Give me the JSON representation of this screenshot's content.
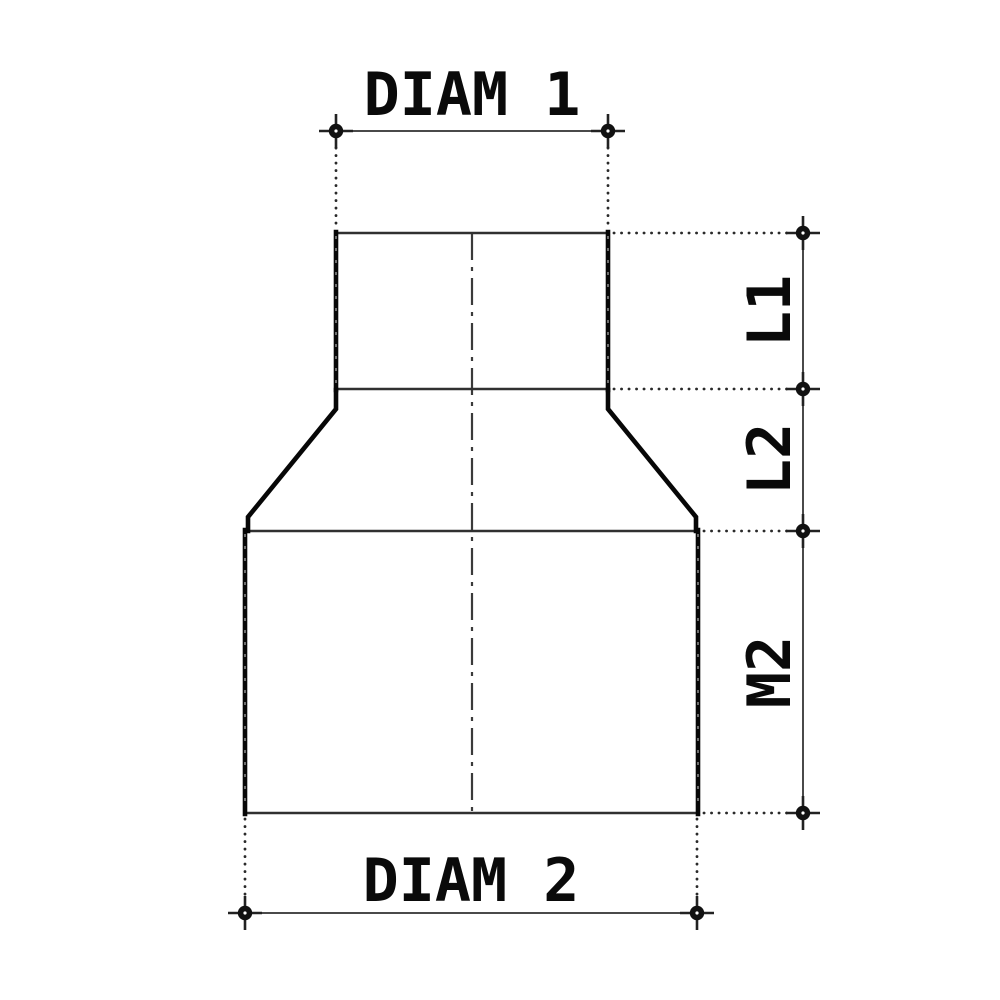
{
  "dimensions": {
    "diam1": {
      "label": "DIAM 1"
    },
    "diam2": {
      "label": "DIAM 2"
    },
    "l1": {
      "label": "L1"
    },
    "l2": {
      "label": "L2"
    },
    "m2": {
      "label": "M2"
    }
  },
  "colors": {
    "background": "#ffffff",
    "outline_thick": "#070707",
    "outline_thin": "#303030",
    "dimension_line": "#4a4a4a",
    "extension_dots": "#2a2a2a",
    "centerline": "#3a3a3a",
    "text": "#0a0a0a"
  }
}
